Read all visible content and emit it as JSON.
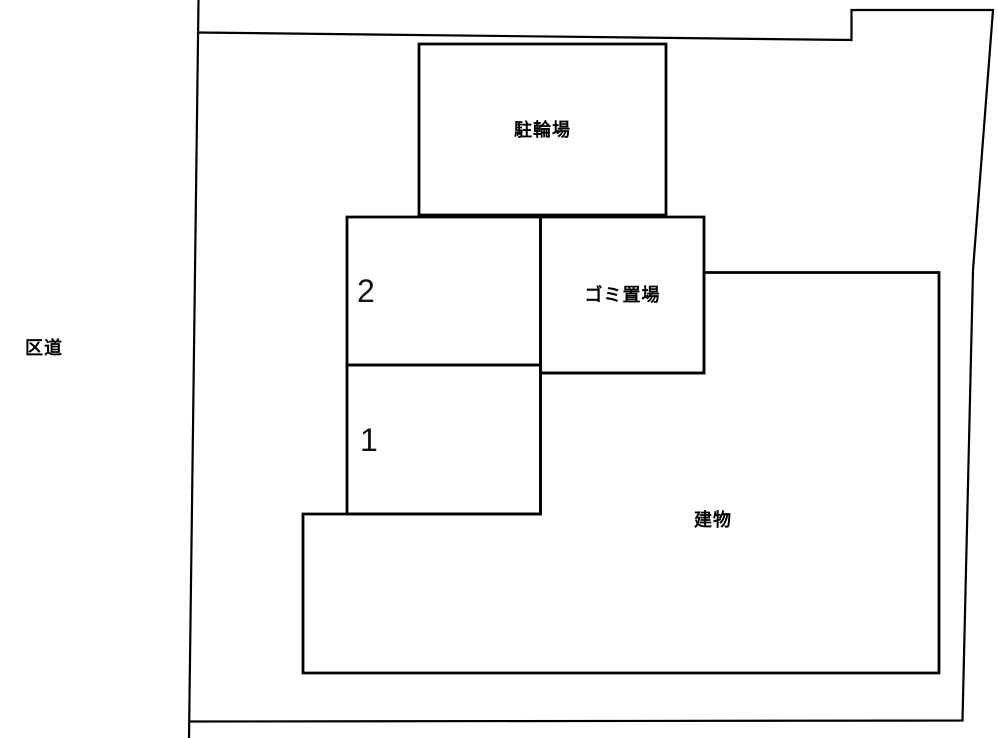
{
  "site_plan": {
    "road_label": "区道",
    "areas": [
      {
        "id": "bicycle-parking",
        "label": "駐輪場"
      },
      {
        "id": "parking-space-2",
        "label": "2"
      },
      {
        "id": "parking-space-1",
        "label": "1"
      },
      {
        "id": "garbage-area",
        "label": "ゴミ置場"
      },
      {
        "id": "building",
        "label": "建物"
      }
    ],
    "colors": {
      "line": "#000000",
      "background": "#ffffff"
    }
  }
}
